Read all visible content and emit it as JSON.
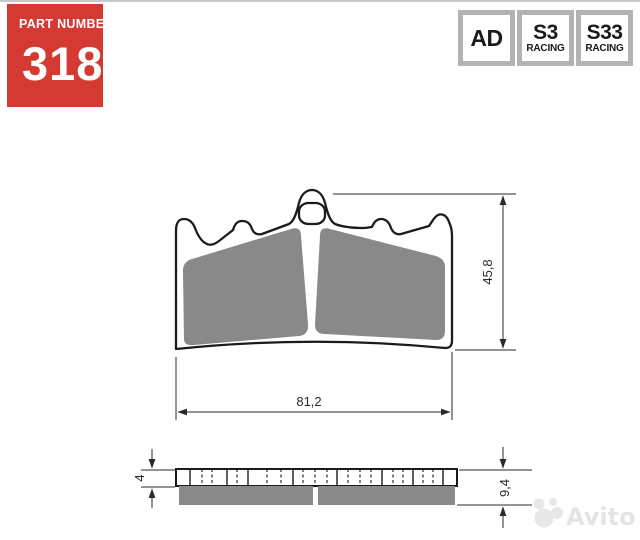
{
  "header": {
    "part_badge": {
      "label": "PART NUMBER",
      "number": "318",
      "bg_color": "#d43a31",
      "text_color": "#ffffff"
    },
    "compound_badges": [
      {
        "code": "AD",
        "sub": ""
      },
      {
        "code": "S3",
        "sub": "RACING"
      },
      {
        "code": "S33",
        "sub": "RACING"
      }
    ],
    "badge_border_color": "#b3b3b3"
  },
  "drawing": {
    "type": "brake-pad-technical-drawing",
    "outline_color": "#1b1b1b",
    "friction_color": "#898989",
    "dimension_color": "#2a2a2a",
    "front_view": {
      "height_mm": "45,8",
      "width_mm": "81,2"
    },
    "side_view": {
      "backing_plate_thickness_mm": "4",
      "total_thickness_mm": "9,4"
    }
  },
  "watermark": {
    "text": "Avito",
    "color": "#e4e4e4"
  }
}
